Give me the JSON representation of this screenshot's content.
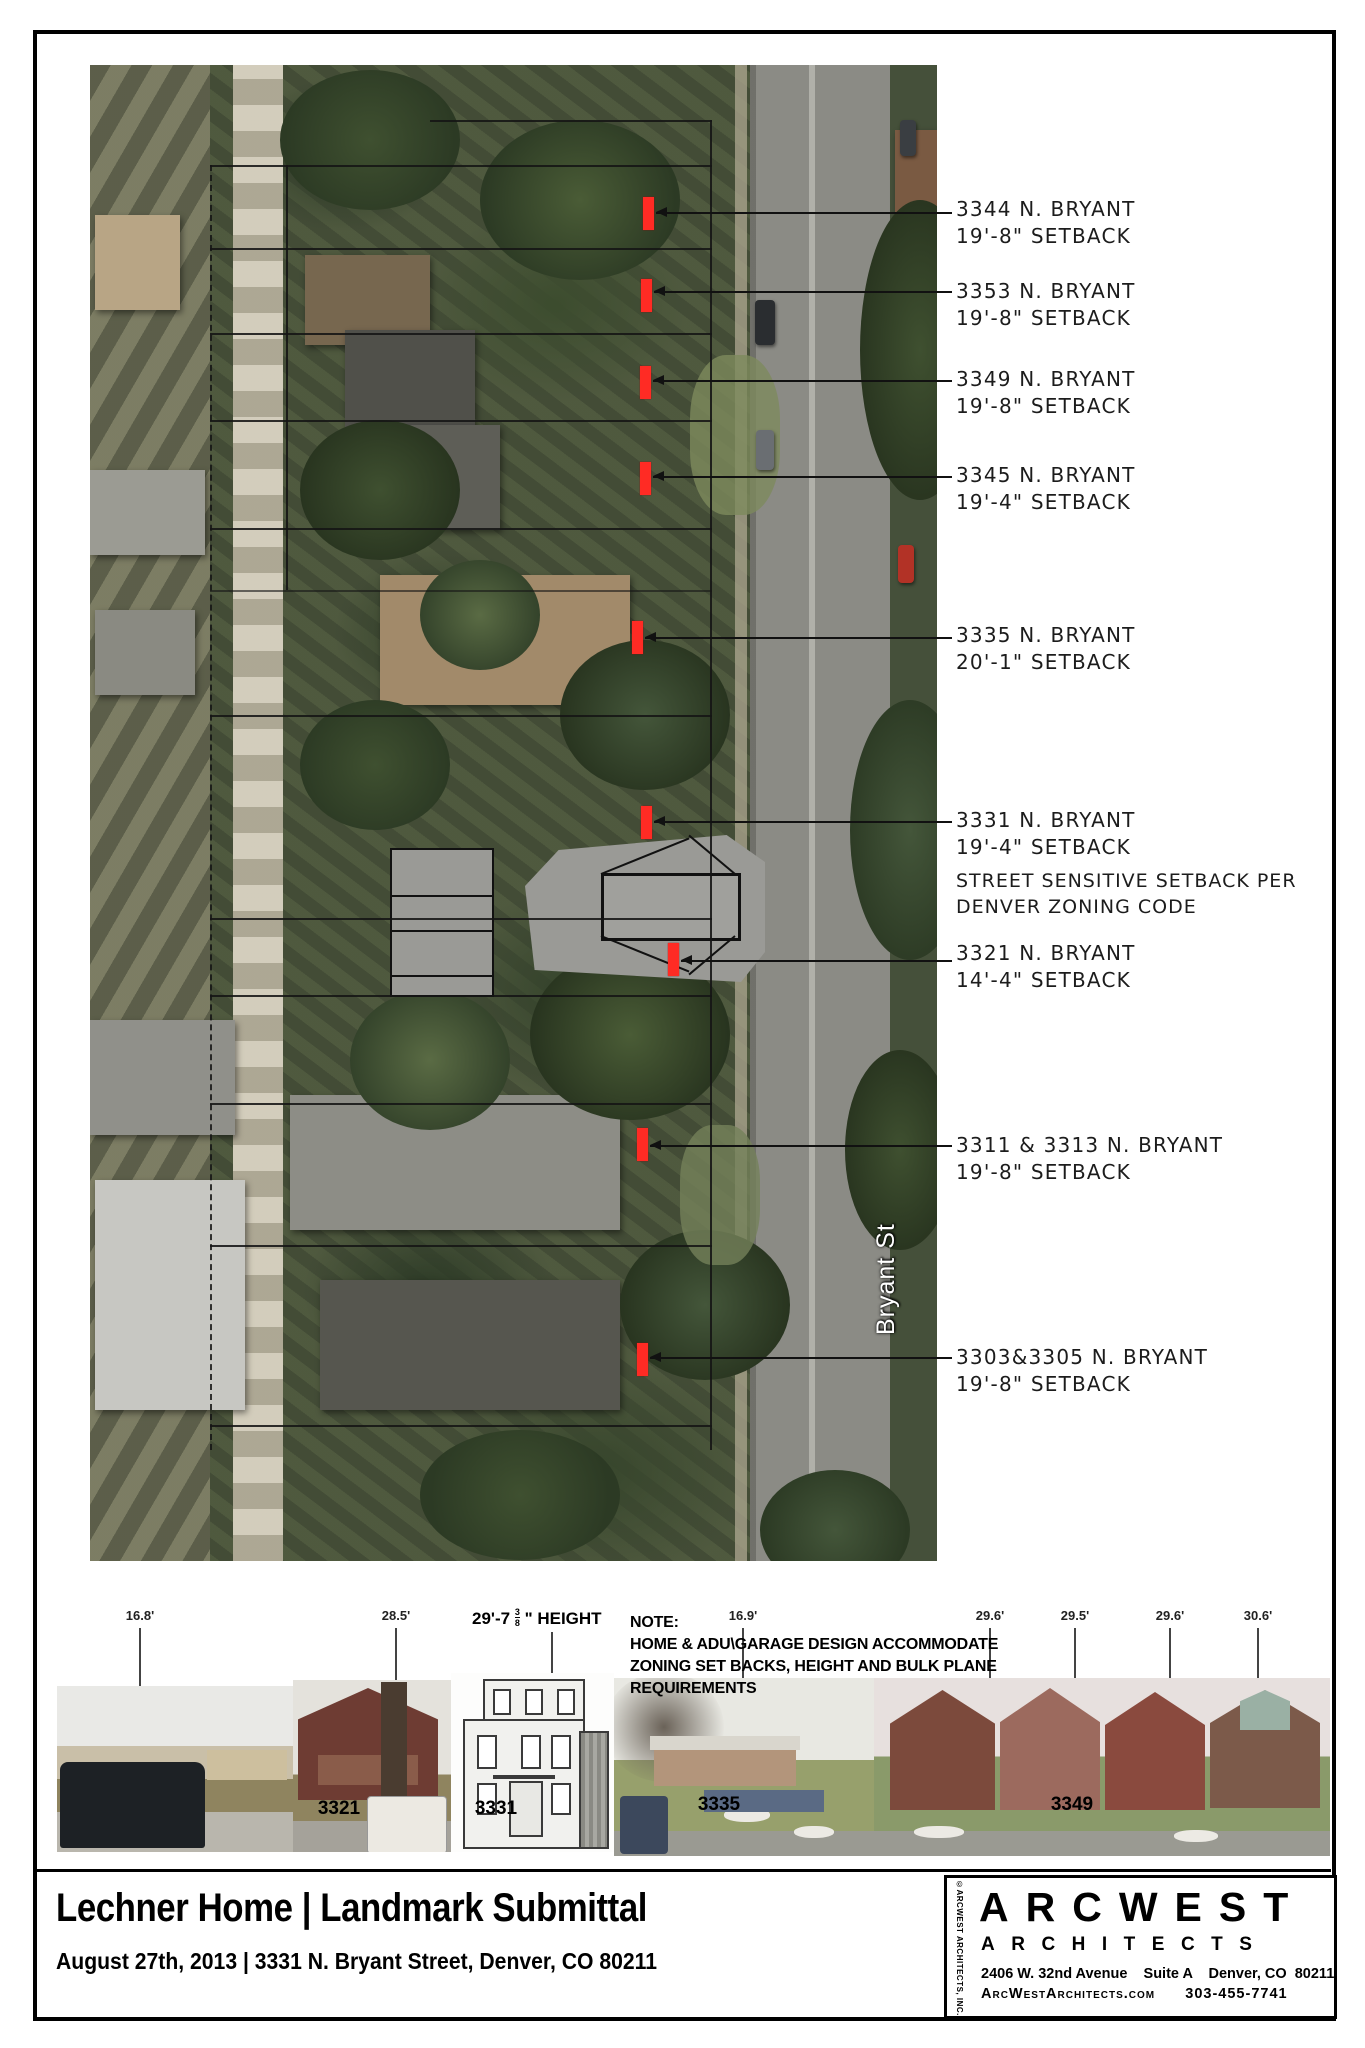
{
  "map": {
    "street_label": "Bryant St",
    "marker_color": "#ff2b24",
    "callouts": [
      {
        "address": "3344 N. BRYANT",
        "setback": "19'-8\" SETBACK"
      },
      {
        "address": "3353 N. BRYANT",
        "setback": "19'-8\" SETBACK"
      },
      {
        "address": "3349 N. BRYANT",
        "setback": "19'-8\" SETBACK"
      },
      {
        "address": "3345 N. BRYANT",
        "setback": "19'-4\" SETBACK"
      },
      {
        "address": "3335 N. BRYANT",
        "setback": "20'-1\" SETBACK"
      },
      {
        "address": "3331 N. BRYANT",
        "setback": "19'-4\" SETBACK"
      },
      {
        "address": "3321 N. BRYANT",
        "setback": "14'-4\" SETBACK"
      },
      {
        "address": "3311 & 3313 N. BRYANT",
        "setback": "19'-8\" SETBACK"
      },
      {
        "address": "3303&3305 N. BRYANT",
        "setback": "19'-8\" SETBACK"
      }
    ],
    "zoning_note_line1": "STREET SENSITIVE SETBACK PER",
    "zoning_note_line2": "DENVER ZONING CODE"
  },
  "elevations": {
    "measurements": [
      "16.8'",
      "28.5'",
      "16.9'",
      "29.6'",
      "29.5'",
      "29.6'",
      "30.6'"
    ],
    "height_prefix": "29'-7",
    "height_frac_num": "3",
    "height_frac_den": "8",
    "height_suffix": "\" HEIGHT",
    "note_title": "NOTE:",
    "note_line1": "HOME & ADU\\GARAGE DESIGN ACCOMMODATE",
    "note_line2": "ZONING SET BACKS, HEIGHT AND BULK PLANE",
    "note_line3": "REQUIREMENTS",
    "house_labels": [
      "3321",
      "3331",
      "3335",
      "3349"
    ]
  },
  "titleblock": {
    "title": "Lechner Home | Landmark Submittal",
    "subtitle": "August 27th, 2013 | 3331 N. Bryant Street, Denver, CO 80211",
    "firm_name": "ARCWEST",
    "firm_sub": "ARCHITECTS",
    "firm_address": "2406 W. 32nd Avenue    Suite A    Denver, CO  80211",
    "firm_contact": "ArcWestArchitects.com      303-455-7741",
    "copyright": "©ARCWEST ARCHITECTS, INC."
  }
}
